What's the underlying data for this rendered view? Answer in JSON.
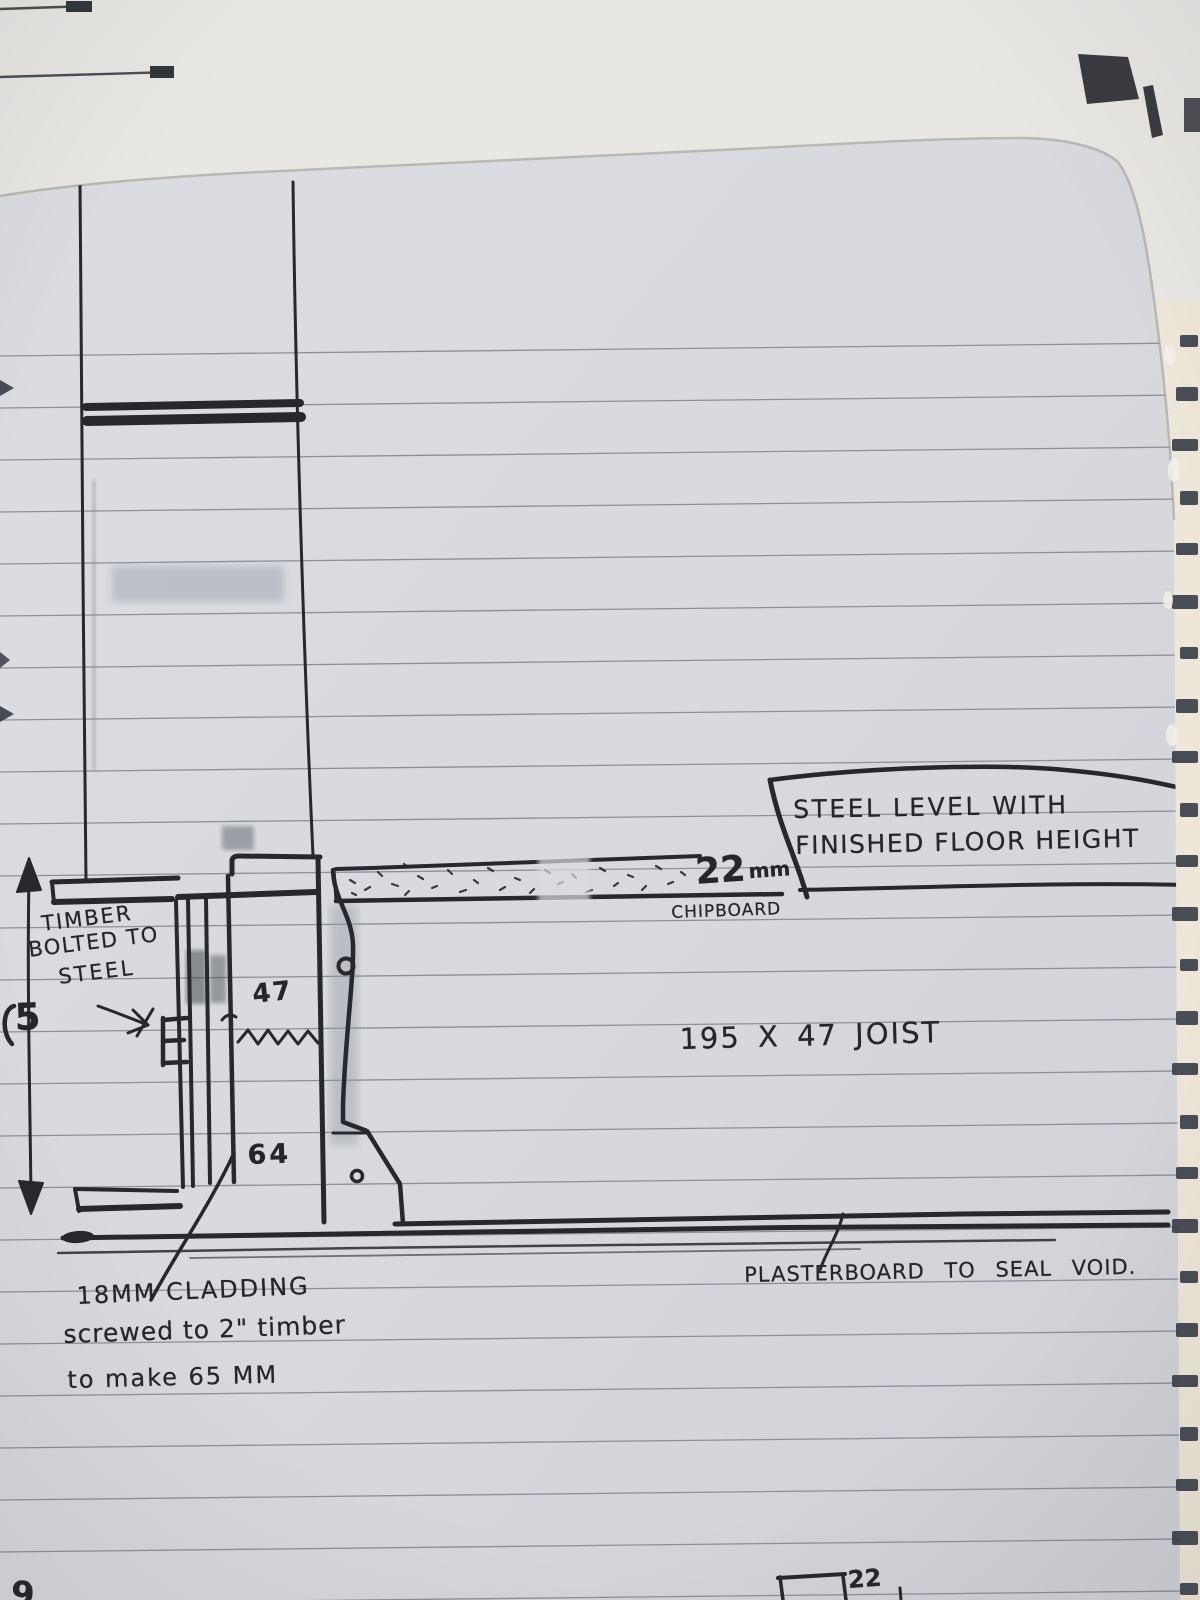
{
  "colors": {
    "ink": "#26282d",
    "paper": "#d8dade",
    "background": "#e8e7e4",
    "ruled_line": "#7f8490",
    "pad_edge": "#ece7d8",
    "edge_mark": "#383c46"
  },
  "labels": {
    "callout_line1": "STEEL LEVEL WITH",
    "callout_line2": "FINISHED FLOOR HEIGHT",
    "chipboard_size": "22",
    "chipboard_unit": "mm",
    "chipboard_word": "CHIPBOARD",
    "joist": "195 X 47 JOIST",
    "timber_line1": "TIMBER",
    "timber_line2": "BOLTED TO",
    "timber_line3": "STEEL",
    "dim_47": "47",
    "dim_64": "64",
    "cladding_line1": "18MM CLADDING",
    "cladding_line2": "screwed to 2\" timber",
    "cladding_line3": "to make 65 MM",
    "plasterboard": "PLASTERBOARD TO SEAL VOID.",
    "left_dim_partial": "5",
    "bottom_dim_partial": "22",
    "bottom_left_partial": "9"
  }
}
